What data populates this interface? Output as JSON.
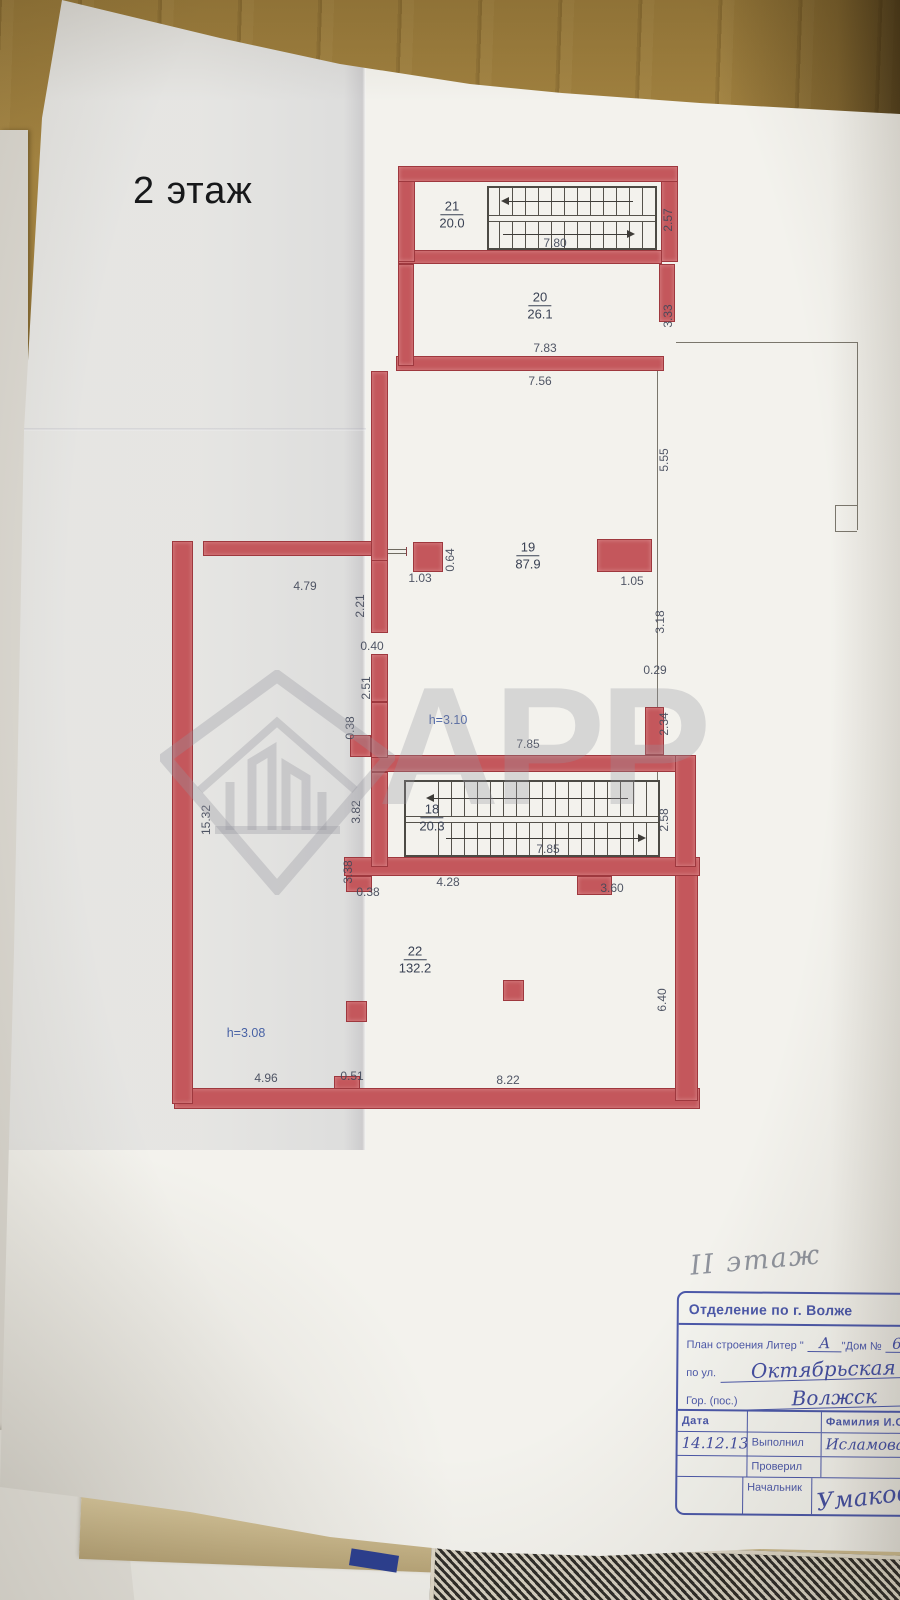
{
  "floor_label": "2 этаж",
  "pencil_note": "II этаж",
  "watermark_text": "АРР",
  "plan": {
    "rooms": [
      {
        "num": "21",
        "area": "20.0",
        "x": 452,
        "y": 215
      },
      {
        "num": "20",
        "area": "26.1",
        "x": 540,
        "y": 306
      },
      {
        "num": "19",
        "area": "87.9",
        "x": 528,
        "y": 556
      },
      {
        "num": "18",
        "area": "20.3",
        "x": 432,
        "y": 818
      },
      {
        "num": "22",
        "area": "132.2",
        "x": 415,
        "y": 960
      }
    ],
    "dims": [
      {
        "t": "7.80",
        "x": 555,
        "y": 243
      },
      {
        "t": "2.57",
        "x": 668,
        "y": 220,
        "r": 1
      },
      {
        "t": "7.83",
        "x": 545,
        "y": 348
      },
      {
        "t": "7.56",
        "x": 540,
        "y": 381
      },
      {
        "t": "3.33",
        "x": 668,
        "y": 316,
        "r": 1
      },
      {
        "t": "5.55",
        "x": 664,
        "y": 460,
        "r": 1
      },
      {
        "t": "1.05",
        "x": 632,
        "y": 581
      },
      {
        "t": "3.18",
        "x": 660,
        "y": 622,
        "r": 1
      },
      {
        "t": "0.29",
        "x": 655,
        "y": 670
      },
      {
        "t": "2.34",
        "x": 664,
        "y": 724,
        "r": 1
      },
      {
        "t": "0.64",
        "x": 450,
        "y": 560,
        "r": 1
      },
      {
        "t": "4.79",
        "x": 305,
        "y": 586
      },
      {
        "t": "1.03",
        "x": 420,
        "y": 578
      },
      {
        "t": "2.21",
        "x": 360,
        "y": 606,
        "r": 1
      },
      {
        "t": "0.40",
        "x": 372,
        "y": 646
      },
      {
        "t": "2.51",
        "x": 366,
        "y": 688,
        "r": 1
      },
      {
        "t": "0.38",
        "x": 350,
        "y": 728,
        "r": 1
      },
      {
        "t": "h=3.10",
        "x": 448,
        "y": 720,
        "cls": "h"
      },
      {
        "t": "7.85",
        "x": 528,
        "y": 744
      },
      {
        "t": "3.82",
        "x": 356,
        "y": 812,
        "r": 1
      },
      {
        "t": "2.58",
        "x": 664,
        "y": 820,
        "r": 1
      },
      {
        "t": "7.85",
        "x": 548,
        "y": 849
      },
      {
        "t": "3.38",
        "x": 348,
        "y": 872,
        "r": 1
      },
      {
        "t": "0.38",
        "x": 368,
        "y": 892
      },
      {
        "t": "4.28",
        "x": 448,
        "y": 882
      },
      {
        "t": "3.60",
        "x": 612,
        "y": 888
      },
      {
        "t": "6.40",
        "x": 662,
        "y": 1000,
        "r": 1
      },
      {
        "t": "15.32",
        "x": 206,
        "y": 820,
        "r": 1
      },
      {
        "t": "h=3.08",
        "x": 246,
        "y": 1033,
        "cls": "h"
      },
      {
        "t": "4.96",
        "x": 266,
        "y": 1078
      },
      {
        "t": "0.51",
        "x": 352,
        "y": 1076
      },
      {
        "t": "8.22",
        "x": 508,
        "y": 1080
      }
    ]
  },
  "stamp": {
    "header": "Отделение по г. Волже",
    "plan_label": "План строения Литер \"",
    "litera": "А",
    "house_label": "\"Дом №",
    "house_value": "62а",
    "street_label": "по ул.",
    "street_value": "Октябрьская",
    "city_label": "Гор. (пос.)",
    "city_value": "Волжск",
    "date_header": "Дата",
    "name_header": "Фамилия И.О",
    "date_value": "14.12.13",
    "done_label": "Выполнил",
    "done_value": "Исламова и",
    "checked_label": "Проверил",
    "chief_label": "Начальник",
    "chief_value": "Умакова"
  }
}
